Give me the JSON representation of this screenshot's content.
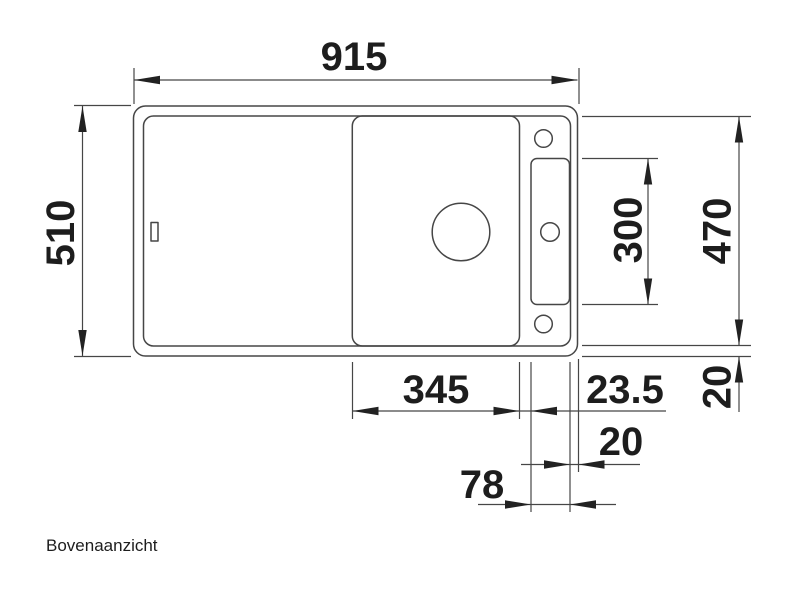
{
  "title": "Bovenaanzicht",
  "dimensions": {
    "total_width": "915",
    "total_depth": "510",
    "inner_depth": "470",
    "tap_ledge_length": "300",
    "bowl_width": "345",
    "bowl_to_ledge_gap": "23.5",
    "ledge_to_rim": "20",
    "bottom_rim": "20",
    "tap_ledge_width": "78"
  },
  "colors": {
    "line": "#464646",
    "arrow": "#222222",
    "text": "#1d1d1d",
    "background": "#ffffff"
  }
}
